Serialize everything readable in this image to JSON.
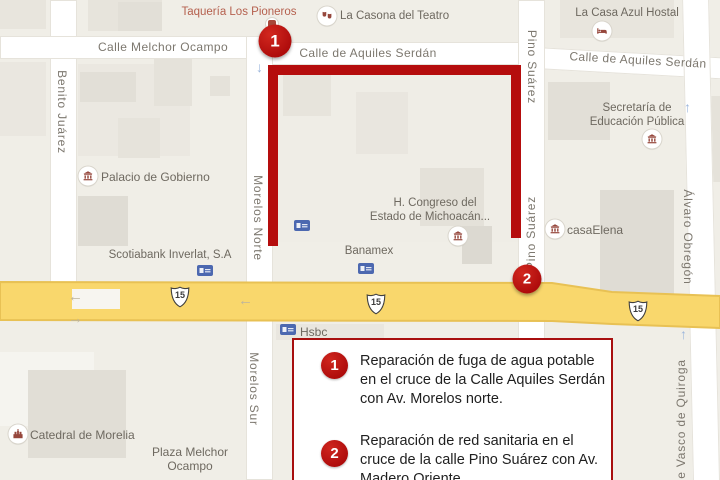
{
  "title": "Map of Morelia repair locations",
  "colors": {
    "route_red": "#b50d0d",
    "marker_red": "#ad0b0b",
    "legend_border_red": "#a80f0f",
    "highway_yellow": "#f9d76c",
    "highway_edge": "#e8c154",
    "street_white": "#ffffff",
    "map_background": "#f0eee7",
    "street_label_gray": "#7d786f",
    "poi_label_gray": "#6e6960",
    "poi_label_red": "#b5604e",
    "atm_blue": "#4c68b0",
    "poi_glyph_red": "#96473c"
  },
  "icons": {
    "arrow_left": "←",
    "arrow_right": "→",
    "arrow_up": "↑",
    "arrow_down": "↓",
    "institution_icon": "classical-building",
    "bed_icon": "bed",
    "theater_icon": "theater-masks",
    "restaurant_icon": "restaurant",
    "church_icon": "cathedral",
    "atm_icon": "bank-atm"
  },
  "map": {
    "highway": {
      "route_number": "15"
    },
    "streets": [
      {
        "label": "Calle Melchor Ocampo",
        "orientation": "horizontal"
      },
      {
        "label": "Calle de Aquiles Serdán",
        "orientation": "horizontal"
      },
      {
        "label": "Calle de Aquiles Serdán",
        "orientation": "horizontal-tilted"
      },
      {
        "label": "Benito Juárez",
        "orientation": "vertical"
      },
      {
        "label": "Morelos Norte",
        "orientation": "vertical"
      },
      {
        "label": "Morelos Sur",
        "orientation": "vertical"
      },
      {
        "label": "Pino Suárez",
        "orientation": "vertical"
      },
      {
        "label": "Pino Suárez",
        "orientation": "vertical-flipped"
      },
      {
        "label": "Álvaro Obregón",
        "orientation": "vertical"
      },
      {
        "label": "e Vasco de Quiroga",
        "orientation": "vertical-flipped"
      }
    ],
    "pois": [
      {
        "label": "Taquería Los Pioneros"
      },
      {
        "label": "La Casona del Teatro"
      },
      {
        "label": "La Casa Azul Hostal"
      },
      {
        "label": "Palacio de Gobierno"
      },
      {
        "label": "Scotiabank Inverlat, S.A"
      },
      {
        "label": "Banamex"
      },
      {
        "label": "Hsbc"
      },
      {
        "line1": "H. Congreso del",
        "line2": "Estado de Michoacán..."
      },
      {
        "label": "casaElena"
      },
      {
        "line1": "Secretaría de",
        "line2": "Educación Pública"
      },
      {
        "label": "Catedral de Morelia"
      },
      {
        "line1": "Plaza Melchor",
        "line2": "Ocampo"
      }
    ]
  },
  "markers": [
    {
      "number": "1"
    },
    {
      "number": "2"
    }
  ],
  "legend": {
    "items": [
      {
        "number": "1",
        "lines": [
          "Reparación de fuga de agua potable",
          "en el cruce de la Calle Aquiles Serdán",
          "con Av. Morelos norte."
        ]
      },
      {
        "number": "2",
        "lines": [
          "Reparación de red sanitaria en el",
          "cruce de la calle Pino Suárez con Av.",
          "Madero Oriente."
        ]
      }
    ]
  }
}
